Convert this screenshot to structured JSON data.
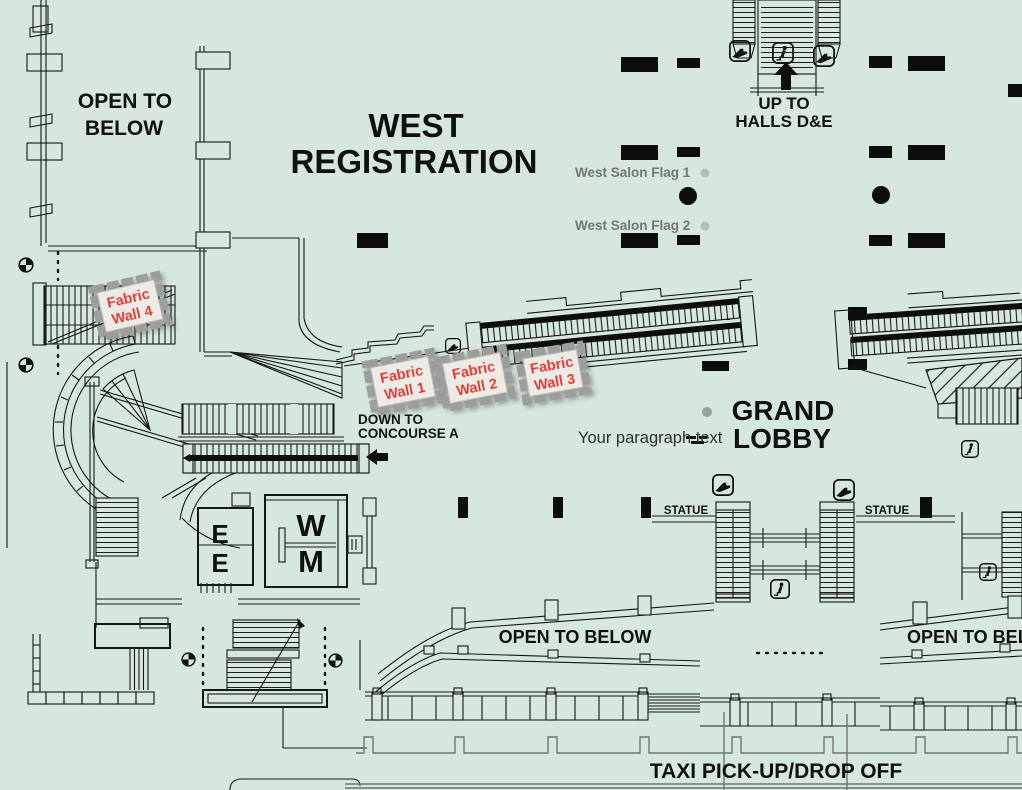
{
  "canvas": {
    "width": 1022,
    "height": 790,
    "background": "#d5e8db"
  },
  "colors": {
    "line": "#161616",
    "pillar": "#0d0d0d",
    "plate_fill": "#edebe6",
    "plate_border": "#9d9d9b",
    "fabric_label_text": "#e8342a",
    "flag_text": "#757575",
    "flag_dot": "#b7bcb7",
    "paragraph_text": "#2e2e2e",
    "paragraph_dot": "#98a29c",
    "curb": "#6f7672"
  },
  "areas": {
    "open_to_below_top": {
      "line1": "OPEN TO",
      "line2": "BELOW"
    },
    "west_registration": {
      "line1": "WEST",
      "line2": "REGISTRATION"
    },
    "up_to_halls": {
      "line1": "UP TO",
      "line2": "HALLS D&E"
    },
    "grand_lobby": {
      "line1": "GRAND",
      "line2": "LOBBY"
    },
    "down_to_concourse": {
      "line1": "DOWN TO",
      "line2": "CONCOURSE A"
    },
    "open_to_below_center": "OPEN TO BELOW",
    "open_to_below_right": "OPEN TO BELOW",
    "taxi": "TAXI PICK-UP/DROP OFF",
    "statue_left": "STATUE",
    "statue_right": "STATUE",
    "elevator_top": "E",
    "elevator_bottom": "E",
    "restroom_women": "W",
    "restroom_men": "M"
  },
  "annotations": {
    "fabric_wall_1": {
      "line1": "Fabric",
      "line2": "Wall 1"
    },
    "fabric_wall_2": {
      "line1": "Fabric",
      "line2": "Wall 2"
    },
    "fabric_wall_3": {
      "line1": "Fabric",
      "line2": "Wall 3"
    },
    "fabric_wall_4": {
      "line1": "Fabric",
      "line2": "Wall 4"
    },
    "west_salon_flag_1": "West Salon Flag 1",
    "west_salon_flag_2": "West Salon Flag 2",
    "your_paragraph_text": "Your paragraph text"
  },
  "icons": {
    "escalator": "escalator-icon",
    "stairs_person": "stairs-person-icon",
    "benchmark": "benchmark-icon",
    "up_arrow": "up-arrow-icon",
    "left_arrow": "left-arrow-icon"
  }
}
